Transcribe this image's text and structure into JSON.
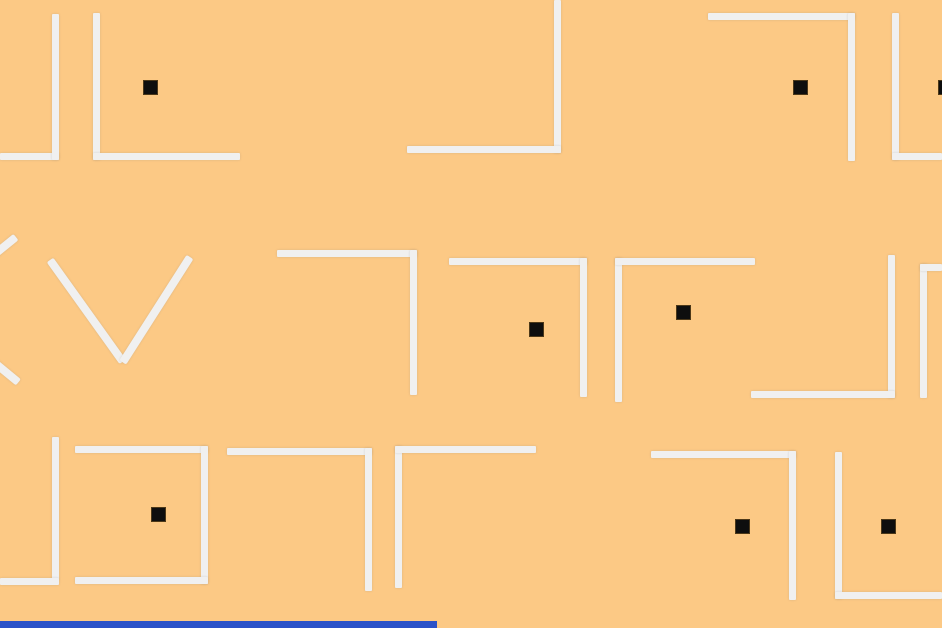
{
  "scene": {
    "canvas": {
      "width": 942,
      "height": 628
    },
    "colors": {
      "background": "#FCC985",
      "wall": "#F0F0F0",
      "pellet": "#0E0E0E",
      "accent_bar": "#2B52C8"
    },
    "wall_thickness": 7,
    "pellet_size": 15
  },
  "walls": [
    {
      "x": 0,
      "y": 153,
      "w": 59,
      "h": 7
    },
    {
      "x": 52,
      "y": 14,
      "w": 7,
      "h": 146
    },
    {
      "x": 93,
      "y": 13,
      "w": 7,
      "h": 147
    },
    {
      "x": 93,
      "y": 153,
      "w": 147,
      "h": 7
    },
    {
      "x": 554,
      "y": 0,
      "w": 7,
      "h": 153
    },
    {
      "x": 407,
      "y": 146,
      "w": 154,
      "h": 7
    },
    {
      "x": 708,
      "y": 13,
      "w": 147,
      "h": 7
    },
    {
      "x": 848,
      "y": 13,
      "w": 7,
      "h": 148
    },
    {
      "x": 892,
      "y": 13,
      "w": 7,
      "h": 147
    },
    {
      "x": 892,
      "y": 153,
      "w": 50,
      "h": 7
    },
    {
      "x": 277,
      "y": 250,
      "w": 140,
      "h": 7
    },
    {
      "x": 410,
      "y": 250,
      "w": 7,
      "h": 145
    },
    {
      "x": 449,
      "y": 258,
      "w": 138,
      "h": 7
    },
    {
      "x": 580,
      "y": 258,
      "w": 7,
      "h": 139
    },
    {
      "x": 615,
      "y": 258,
      "w": 7,
      "h": 144
    },
    {
      "x": 615,
      "y": 258,
      "w": 140,
      "h": 7
    },
    {
      "x": 888,
      "y": 255,
      "w": 7,
      "h": 143
    },
    {
      "x": 751,
      "y": 391,
      "w": 144,
      "h": 7
    },
    {
      "x": 920,
      "y": 264,
      "w": 7,
      "h": 134
    },
    {
      "x": 920,
      "y": 264,
      "w": 22,
      "h": 7
    },
    {
      "x": 52,
      "y": 437,
      "w": 7,
      "h": 143
    },
    {
      "x": 0,
      "y": 578,
      "w": 59,
      "h": 7
    },
    {
      "x": 75,
      "y": 446,
      "w": 133,
      "h": 7
    },
    {
      "x": 201,
      "y": 446,
      "w": 7,
      "h": 138
    },
    {
      "x": 75,
      "y": 577,
      "w": 133,
      "h": 7
    },
    {
      "x": 227,
      "y": 448,
      "w": 145,
      "h": 7
    },
    {
      "x": 365,
      "y": 448,
      "w": 7,
      "h": 143
    },
    {
      "x": 395,
      "y": 446,
      "w": 7,
      "h": 142
    },
    {
      "x": 395,
      "y": 446,
      "w": 141,
      "h": 7
    },
    {
      "x": 651,
      "y": 451,
      "w": 145,
      "h": 7
    },
    {
      "x": 789,
      "y": 451,
      "w": 7,
      "h": 149
    },
    {
      "x": 835,
      "y": 452,
      "w": 7,
      "h": 147
    },
    {
      "x": 835,
      "y": 592,
      "w": 107,
      "h": 7
    }
  ],
  "diagonal_walls": [
    {
      "x1": -72,
      "y1": 308,
      "x2": 16,
      "y2": 237
    },
    {
      "x1": -72,
      "y1": 308,
      "x2": 18,
      "y2": 382
    },
    {
      "x1": 50,
      "y1": 260,
      "x2": 123,
      "y2": 362
    },
    {
      "x1": 190,
      "y1": 257,
      "x2": 123,
      "y2": 362
    }
  ],
  "pellets": [
    {
      "x": 150,
      "y": 87
    },
    {
      "x": 800,
      "y": 87
    },
    {
      "x": 945,
      "y": 87
    },
    {
      "x": 536,
      "y": 329
    },
    {
      "x": 683,
      "y": 312
    },
    {
      "x": 158,
      "y": 514
    },
    {
      "x": 742,
      "y": 526
    },
    {
      "x": 888,
      "y": 526
    }
  ],
  "accent_bar": {
    "x": 0,
    "y": 621,
    "w": 437,
    "h": 7
  }
}
